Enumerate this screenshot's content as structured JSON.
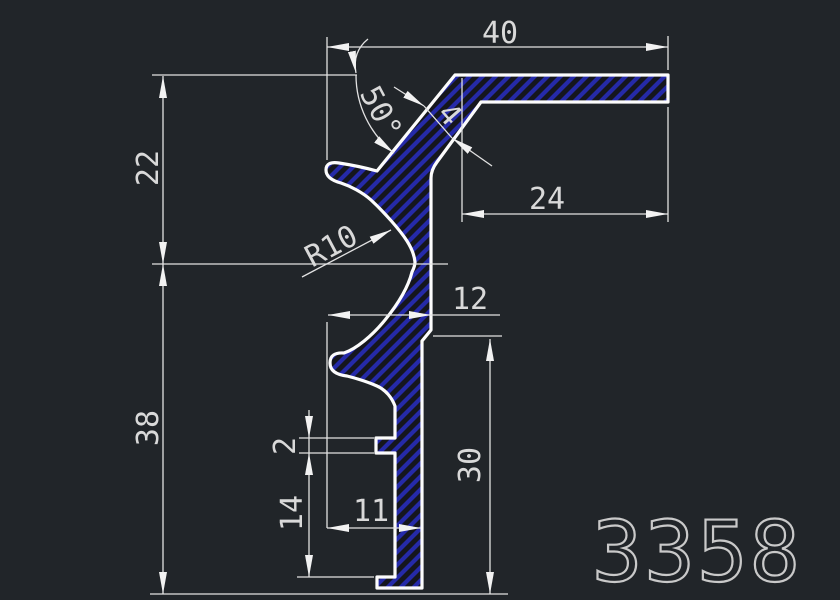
{
  "drawing": {
    "part_number": "3358",
    "dims": {
      "width_top": "40",
      "angle": "50°",
      "wall_thickness": "4",
      "height_upper": "22",
      "flange_depth": "24",
      "radius": "R10",
      "width_mid": "12",
      "height_lower": "38",
      "rib_height": "2",
      "rib_to_foot": "14",
      "width_bottom": "11",
      "stem_height": "30"
    },
    "colors": {
      "background": "#212529",
      "outline": "#fcfcfc",
      "hatch_blue": "#252aa8",
      "interior": "#15161d",
      "dimension_lines": "#e2e2e2",
      "dimension_text": "#d9d9d9",
      "part_number_text": "#c9c9c9"
    }
  }
}
